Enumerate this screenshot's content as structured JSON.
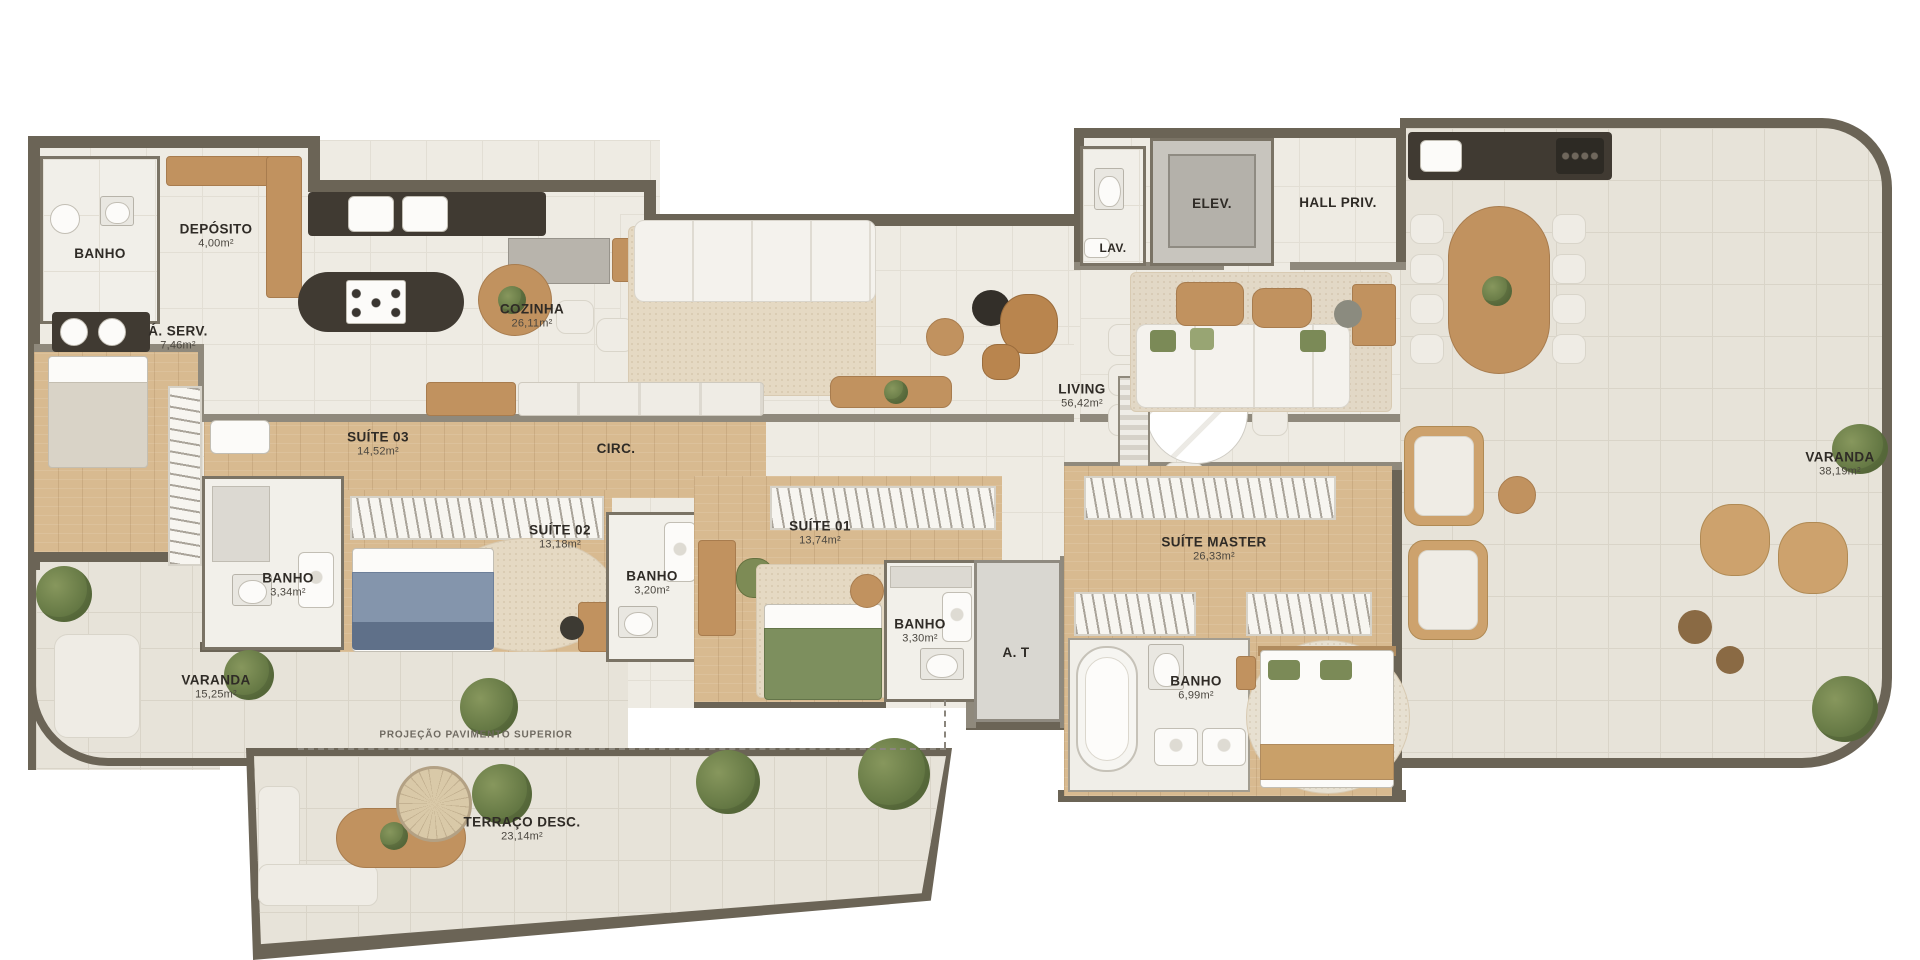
{
  "plan": {
    "rooms": {
      "banho_servico": {
        "name": "BANHO"
      },
      "deposito": {
        "name": "DEPÓSITO",
        "area": "4,00m²"
      },
      "area_servico": {
        "name": "Á. SERV.",
        "area": "7,46m²"
      },
      "cozinha": {
        "name": "COZINHA",
        "area": "26,11m²"
      },
      "lav": {
        "name": "LAV."
      },
      "elev": {
        "name": "ELEV."
      },
      "hall_priv": {
        "name": "HALL PRIV."
      },
      "living": {
        "name": "LIVING",
        "area": "56,42m²"
      },
      "varanda_direita": {
        "name": "VARANDA",
        "area": "38,19m²"
      },
      "suite_03": {
        "name": "SUÍTE 03",
        "area": "14,52m²"
      },
      "circ": {
        "name": "CIRC."
      },
      "suite_02": {
        "name": "SUÍTE 02",
        "area": "13,18m²"
      },
      "banho_suite_03": {
        "name": "BANHO",
        "area": "3,34m²"
      },
      "banho_suite_02": {
        "name": "BANHO",
        "area": "3,20m²"
      },
      "suite_01": {
        "name": "SUÍTE 01",
        "area": "13,74m²"
      },
      "banho_suite_01": {
        "name": "BANHO",
        "area": "3,30m²"
      },
      "area_tecnica": {
        "name": "A. T"
      },
      "suite_master": {
        "name": "SUÍTE MASTER",
        "area": "26,33m²"
      },
      "banho_master": {
        "name": "BANHO",
        "area": "6,99m²"
      },
      "varanda_esquerda": {
        "name": "VARANDA",
        "area": "15,25m²"
      },
      "terraco": {
        "name": "TERRAÇO DESC.",
        "area": "23,14m²"
      }
    },
    "annotations": {
      "projecao": "PROJEÇÃO PAVIMENTO SUPERIOR"
    },
    "palette": {
      "wall": "#6b6456",
      "floor_indoor": "#eeebe3",
      "floor_outdoor": "#e7e3d9",
      "wood_floor": "#d8ba90",
      "counter_dark": "#403a32",
      "bed_blue": "#8495ac",
      "bed_green": "#7d8f5e",
      "pillow_green": "#7b8a57",
      "plant_green": "#5f7340",
      "rug": "#e5d9c3"
    }
  }
}
